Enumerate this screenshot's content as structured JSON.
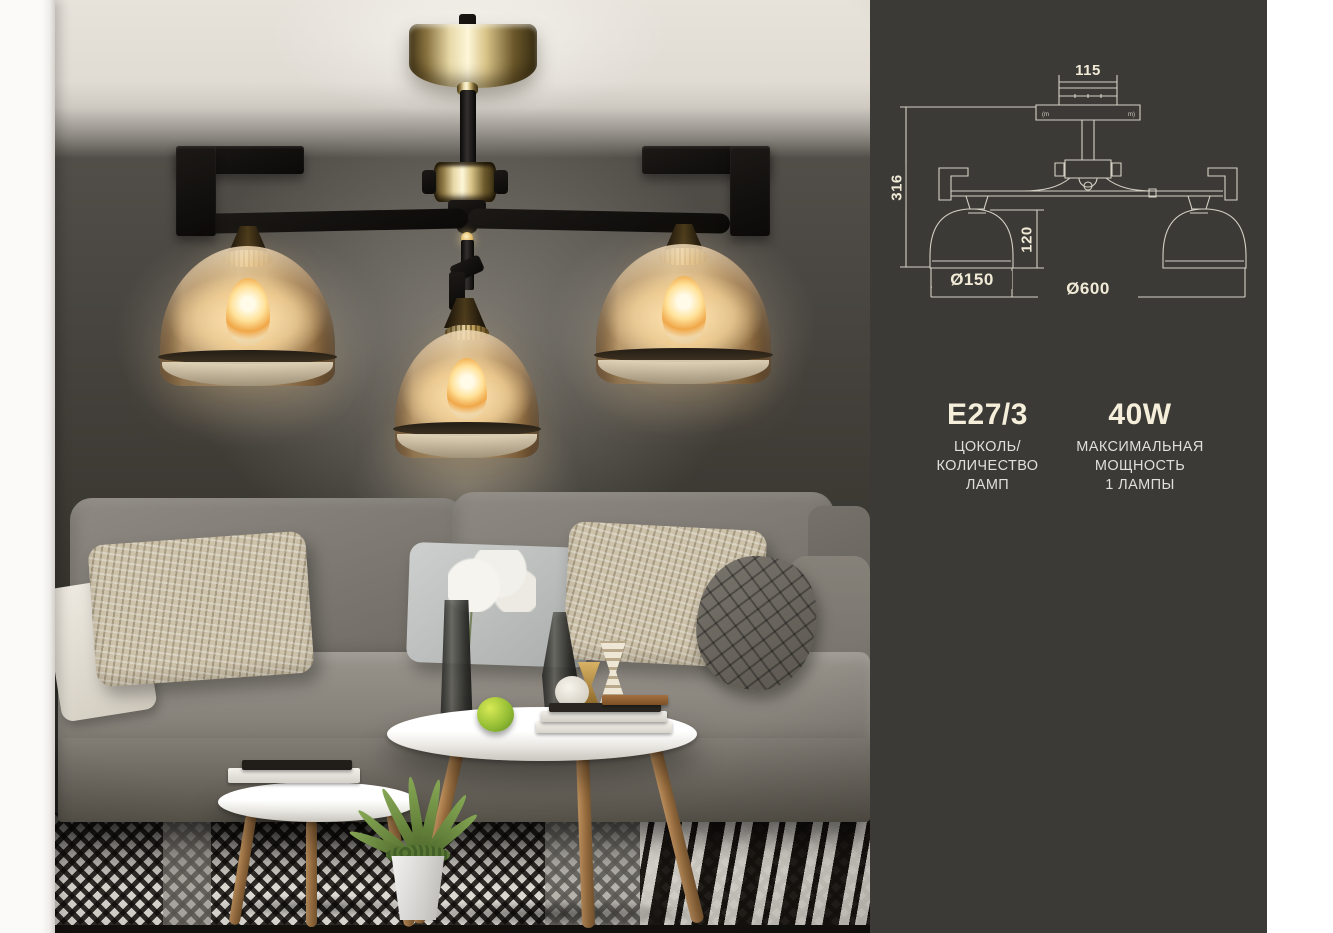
{
  "panel": {
    "diagram": {
      "labels": {
        "canopy_width": "115",
        "fixture_height": "316",
        "shade_height": "120",
        "shade_diameter": "Ø150",
        "fixture_diameter": "Ø600"
      },
      "marks": {
        "left": "(m",
        "right": "m)"
      }
    },
    "specs": [
      {
        "value": "E27/3",
        "label_lines": [
          "ЦОКОЛЬ/",
          "КОЛИЧЕСТВО",
          "ЛАМП"
        ]
      },
      {
        "value": "40W",
        "label_lines": [
          "МАКСИМАЛЬНАЯ",
          "МОЩНОСТЬ",
          "1 ЛАМПЫ"
        ]
      }
    ],
    "colors": {
      "panel_bg": "#3b3a36",
      "line": "#d5d1c5",
      "dimension_text": "#f0ead6",
      "value_text": "#f4eeda",
      "label_text": "#dfdfdc"
    }
  },
  "scene": {
    "colors": {
      "gold_metal": "#d9c488",
      "amber_glass": "#eed4a8",
      "black_metal": "#15120e",
      "wall": "#4a4742",
      "ceiling": "#e2ddd5",
      "sofa": "#7e7971",
      "rug_dark": "#17130f",
      "rug_light": "#e3dfd7"
    }
  }
}
